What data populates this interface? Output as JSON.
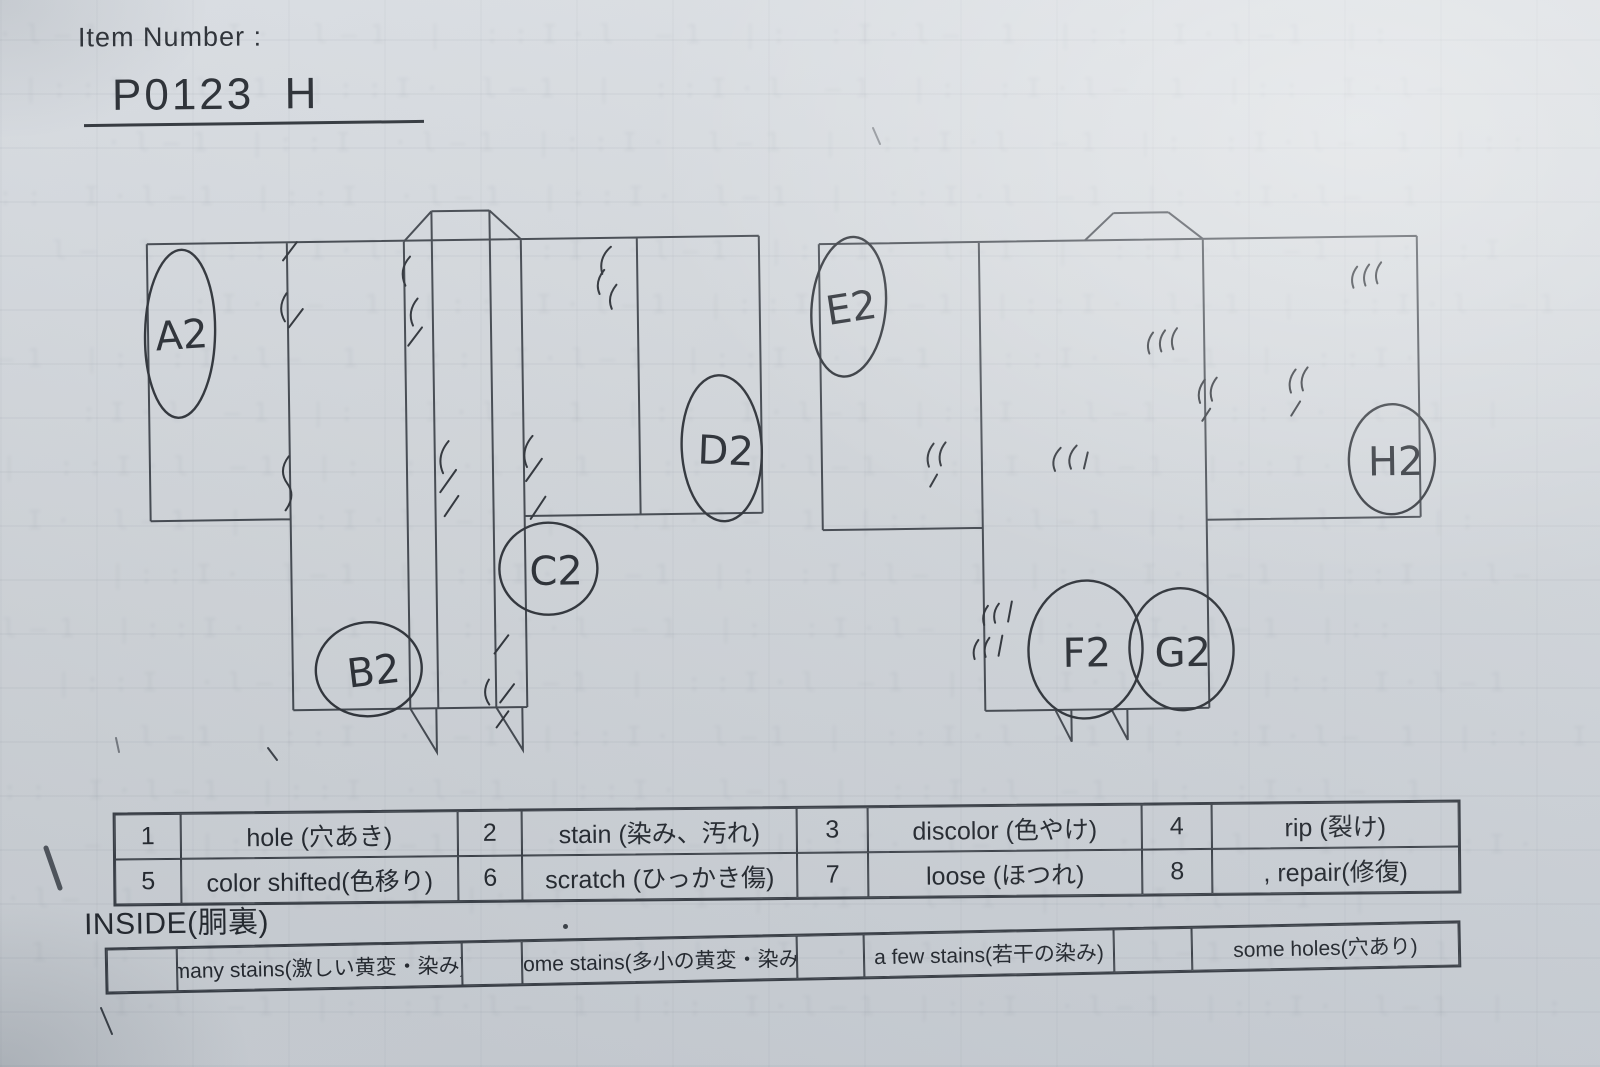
{
  "header": {
    "label": "Item Number :",
    "value": "P0123  H"
  },
  "diagrams": {
    "front": {
      "markers": [
        "A2",
        "B2",
        "C2",
        "D2"
      ]
    },
    "back": {
      "markers": [
        "E2",
        "F2",
        "G2",
        "H2"
      ]
    }
  },
  "legend": {
    "items": [
      {
        "num": "1",
        "label": "hole (穴あき)"
      },
      {
        "num": "2",
        "label": "stain (染み、汚れ)"
      },
      {
        "num": "3",
        "label": "discolor (色やけ)"
      },
      {
        "num": "4",
        "label": "rip (裂け)"
      },
      {
        "num": "5",
        "label": "color shifted(色移り)"
      },
      {
        "num": "6",
        "label": "scratch (ひっかき傷)"
      },
      {
        "num": "7",
        "label": "loose (ほつれ)"
      },
      {
        "num": "8",
        "label": ", repair(修復)"
      }
    ]
  },
  "inside": {
    "title": "INSIDE(胴裏)",
    "options": [
      {
        "label": "many stains(激しい黄変・染み)"
      },
      {
        "label": "some stains(多小の黄変・染み)"
      },
      {
        "label": "a few stains(若干の染み)"
      },
      {
        "label": "some holes(穴あり)"
      }
    ]
  },
  "colors": {
    "paper": "#d6dade",
    "ink": "#2c3036",
    "print": "#22262c"
  }
}
